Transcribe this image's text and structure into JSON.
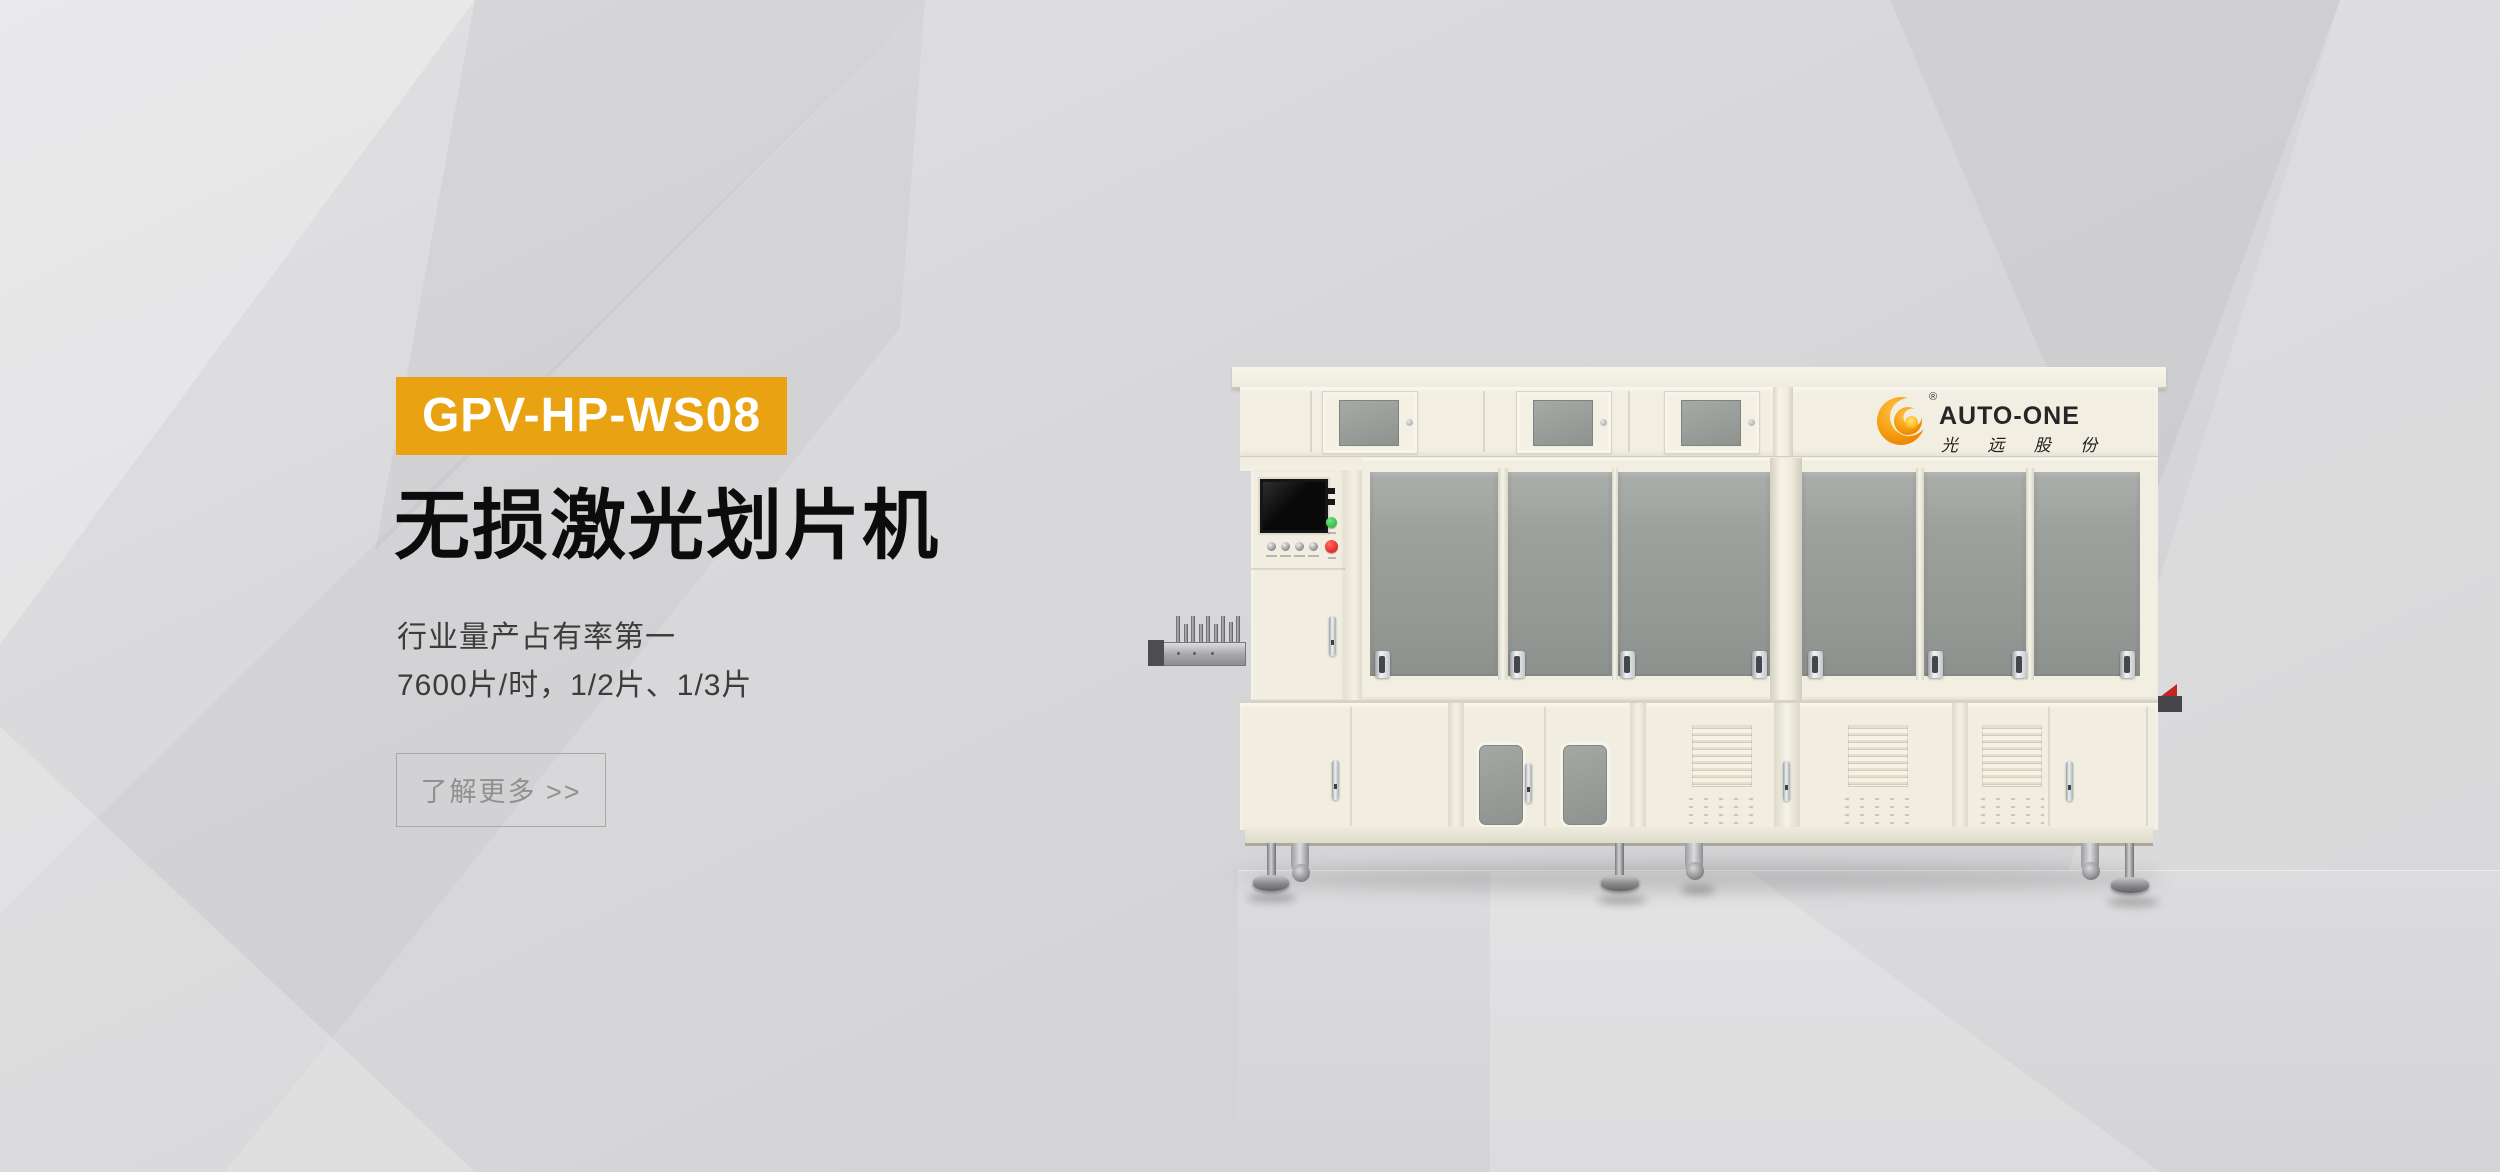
{
  "hero": {
    "model_badge": "GPV-HP-WS08",
    "title": "无损激光划片机",
    "subtitle_line1": "行业量产占有率第一",
    "subtitle_line2": "7600片/时，1/2片、1/3片",
    "cta_label": "了解更多 >>"
  },
  "machine_brand": {
    "name": "AUTO-ONE",
    "registered_mark": "®",
    "chinese_name": "光 远 股 份"
  },
  "colors": {
    "accent_orange": "#E9A312",
    "brand_orange_dark": "#EF8E00",
    "brand_orange_light": "#FFB31A",
    "machine_cream": "#F2EFE2",
    "glass_gray": "#9BA09C",
    "indicator_green": "#1FAF33",
    "indicator_red": "#D80F0F",
    "background_gray": "#D6D6D8"
  }
}
